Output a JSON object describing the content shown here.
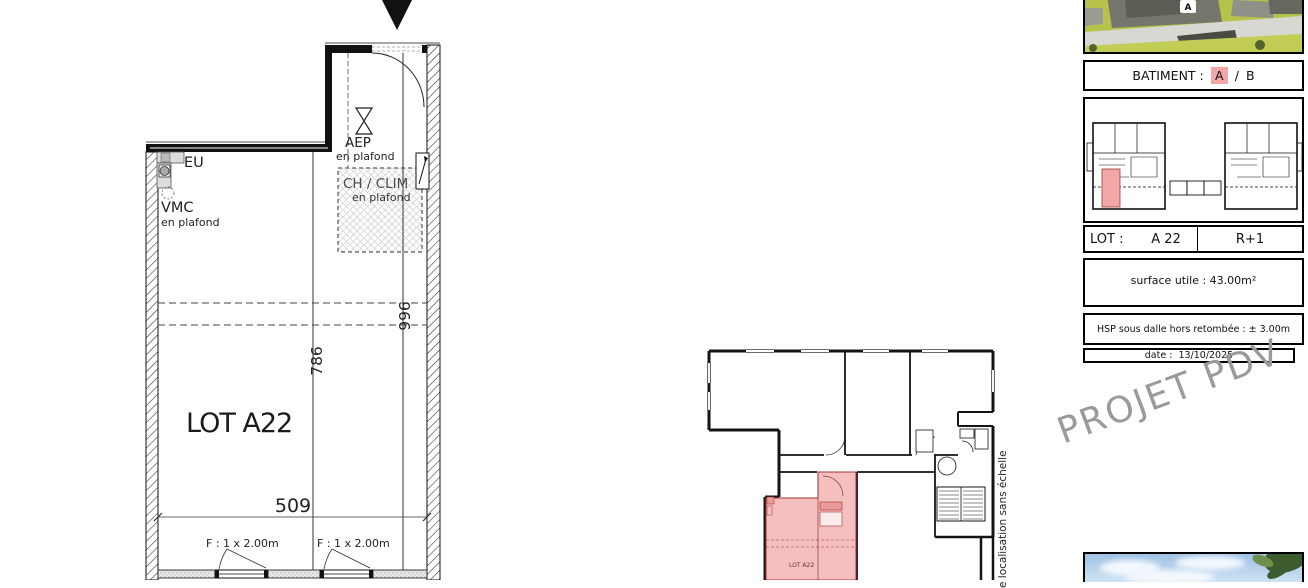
{
  "main_plan": {
    "lot_label": "LOT A22",
    "eu_label": "EU",
    "vmc_label": "VMC",
    "vmc_sub": "en plafond",
    "aep_label": "AEP",
    "aep_sub": "en plafond",
    "chclim_label": "CH / CLIM",
    "chclim_sub": "en plafond",
    "window_label_1": "F : 1 x 2.00m",
    "window_label_2": "F : 1 x 2.00m",
    "dim_width": "509",
    "dim_room": "786",
    "dim_total": "996"
  },
  "location_plan": {
    "lot_label": "LOT A22",
    "side_note": "e localisation sans échelle"
  },
  "title_block": {
    "render_badge": "A",
    "batiment_label": "BATIMENT :",
    "batiment_a": "A",
    "batiment_sep": "/",
    "batiment_b": "B",
    "lot_label": "LOT :",
    "lot_value": "A 22",
    "level_value": "R+1",
    "surface_text": "surface utile : 43.00m²",
    "hsp_text": "HSP sous dalle hors retombée : ± 3.00m",
    "date_label": "date :",
    "date_value": "13/10/2025"
  },
  "watermark": "PROJET PDV",
  "colors": {
    "highlight_pink": "#f4b4b4",
    "highlight_pink_line": "#8c3333",
    "badge_pink": "#f2a6a6",
    "watermark_gray": "#9a9a9a",
    "line_black": "#141414"
  }
}
